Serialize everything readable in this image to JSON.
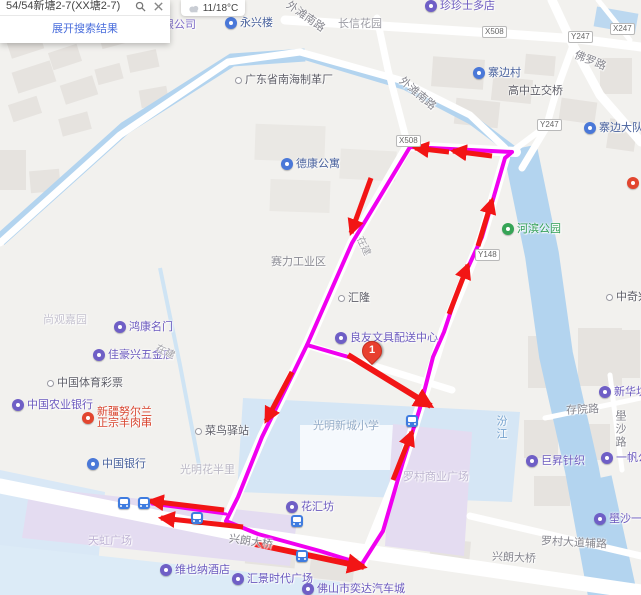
{
  "ui": {
    "search": {
      "query": "54/54新塘2-7(XX塘2-7)",
      "expand_label": "展开搜索结果"
    },
    "weather": {
      "temp": "11/18°C"
    }
  },
  "map": {
    "poi_markers": [
      {
        "label": "珍珍士多店",
        "x": 431,
        "y": 6,
        "type": "purple"
      },
      {
        "label": "永兴楼",
        "x": 231,
        "y": 23,
        "type": "blue"
      },
      {
        "label": "寨边村",
        "x": 479,
        "y": 73,
        "type": "blue"
      },
      {
        "label": "寨边大队",
        "x": 590,
        "y": 128,
        "type": "blue"
      },
      {
        "label": "德康公寓",
        "x": 287,
        "y": 164,
        "type": "blue"
      },
      {
        "label": "河滨公园",
        "x": 508,
        "y": 229,
        "type": "green"
      },
      {
        "label": "广东省南海制革厂",
        "x": 241,
        "y": 81,
        "type": "dot"
      },
      {
        "label": "汇隆",
        "x": 344,
        "y": 299,
        "type": "dot"
      },
      {
        "label": "良友文具配送中心",
        "x": 341,
        "y": 338,
        "type": "purple"
      },
      {
        "label": "鸿康名门",
        "x": 120,
        "y": 327,
        "type": "purple"
      },
      {
        "label": "佳豪兴五金店",
        "x": 99,
        "y": 355,
        "type": "purple"
      },
      {
        "label": "中国体育彩票",
        "x": 53,
        "y": 384,
        "type": "dot"
      },
      {
        "label": "中国农业银行",
        "x": 18,
        "y": 405,
        "type": "purple"
      },
      {
        "label": "新疆努尔兰\n正宗羊肉串",
        "x": 88,
        "y": 413,
        "type": "red"
      },
      {
        "label": "菜鸟驿站",
        "x": 201,
        "y": 432,
        "type": "dot"
      },
      {
        "label": "中国银行",
        "x": 93,
        "y": 464,
        "type": "blue"
      },
      {
        "label": "花汇坊",
        "x": 292,
        "y": 507,
        "type": "purple"
      },
      {
        "label": "维也纳酒店",
        "x": 166,
        "y": 570,
        "type": "purple"
      },
      {
        "label": "汇景时代广场",
        "x": 238,
        "y": 579,
        "type": "purple"
      },
      {
        "label": "佛山市奕达汽车城",
        "x": 308,
        "y": 589,
        "type": "purple"
      },
      {
        "label": "新华坊纺织",
        "x": 605,
        "y": 392,
        "type": "purple"
      },
      {
        "label": "巨昇针织",
        "x": 532,
        "y": 461,
        "type": "purple"
      },
      {
        "label": "一帆公寓",
        "x": 607,
        "y": 458,
        "type": "purple"
      },
      {
        "label": "壆沙一路三",
        "x": 600,
        "y": 519,
        "type": "purple"
      },
      {
        "label": "中奇兴",
        "x": 612,
        "y": 298,
        "type": "dot"
      },
      {
        "label": "",
        "x": 633,
        "y": 183,
        "type": "red"
      }
    ],
    "area_labels": [
      {
        "label": "限公司",
        "x": 163,
        "y": 16,
        "color": "#7d6bc8",
        "size": 11
      },
      {
        "label": "长信花园",
        "x": 338,
        "y": 15,
        "color": "#9b9ba3",
        "size": 11
      },
      {
        "label": "高中立交桥",
        "x": 508,
        "y": 82,
        "color": "#5d5d66",
        "size": 11
      },
      {
        "label": "赛力工业区",
        "x": 271,
        "y": 253,
        "color": "#8a8a92",
        "size": 11
      },
      {
        "label": "尚观嘉园",
        "x": 43,
        "y": 311,
        "color": "#c5c2cf",
        "size": 11
      },
      {
        "label": "光明花半里",
        "x": 180,
        "y": 461,
        "color": "#bab7c4",
        "size": 11
      },
      {
        "label": "光明新城小学",
        "x": 313,
        "y": 417,
        "color": "#93abc7",
        "size": 11
      },
      {
        "label": "罗村商业广场",
        "x": 403,
        "y": 468,
        "color": "#bcb4cf",
        "size": 11
      },
      {
        "label": "天虹广场",
        "x": 88,
        "y": 532,
        "color": "#beb2d4",
        "size": 11
      },
      {
        "label": "在建",
        "x": 355,
        "y": 238,
        "color": "#a3a3a8",
        "size": 10,
        "angle": 65
      },
      {
        "label": "在建",
        "x": 156,
        "y": 343,
        "color": "#a3a3a8",
        "size": 10,
        "angle": 25
      }
    ],
    "road_labels": [
      {
        "label": "外滩南路",
        "x": 284,
        "y": 8,
        "angle": 35
      },
      {
        "label": "外滩南路",
        "x": 396,
        "y": 85,
        "angle": 40
      },
      {
        "label": "佛罗路",
        "x": 574,
        "y": 52,
        "angle": 22
      },
      {
        "label": "兴朗大桥",
        "x": 229,
        "y": 533,
        "angle": 8
      },
      {
        "label": "兴朗大桥",
        "x": 492,
        "y": 549,
        "angle": 3
      },
      {
        "label": "罗村大道辅路",
        "x": 541,
        "y": 534,
        "angle": 3
      },
      {
        "label": "存院路",
        "x": 566,
        "y": 401,
        "angle": -3
      },
      {
        "label": "壆沙路",
        "x": 612,
        "y": 410,
        "vertical": true
      }
    ],
    "water_labels": [
      {
        "label": "汾江",
        "x": 493,
        "y": 415,
        "vertical": true
      }
    ],
    "road_badges": [
      {
        "label": "X508",
        "x": 482,
        "y": 26
      },
      {
        "label": "Y247",
        "x": 568,
        "y": 31
      },
      {
        "label": "X247",
        "x": 610,
        "y": 23
      },
      {
        "label": "Y247",
        "x": 537,
        "y": 119
      },
      {
        "label": "X508",
        "x": 396,
        "y": 135
      },
      {
        "label": "Y148",
        "x": 475,
        "y": 249
      }
    ],
    "bus_stops": [
      {
        "x": 124,
        "y": 503
      },
      {
        "x": 144,
        "y": 503
      },
      {
        "x": 197,
        "y": 518
      },
      {
        "x": 297,
        "y": 521
      },
      {
        "x": 302,
        "y": 556
      },
      {
        "x": 412,
        "y": 421
      }
    ],
    "origin_marker": {
      "label": "1",
      "x": 371,
      "y": 355
    },
    "route": {
      "color": "#f000f0",
      "arrow_color": "#f21515",
      "lines": [
        {
          "points": "512,152 410,147 352,243 307,345 262,437 238,497 226,521 258,534 320,551 362,564 383,531 403,462 420,408 433,357 444,332 459,287 482,237 494,196 505,158 512,152",
          "width": 4
        },
        {
          "points": "307,345 352,358",
          "width": 4
        },
        {
          "points": "226,514 152,504",
          "width": 3
        }
      ],
      "arrows": [
        {
          "x1": 492,
          "y1": 156,
          "x2": 453,
          "y2": 151,
          "w": 5
        },
        {
          "x1": 449,
          "y1": 152,
          "x2": 415,
          "y2": 148,
          "w": 5
        },
        {
          "x1": 371,
          "y1": 178,
          "x2": 351,
          "y2": 233,
          "w": 5
        },
        {
          "x1": 292,
          "y1": 372,
          "x2": 266,
          "y2": 421,
          "w": 5
        },
        {
          "x1": 224,
          "y1": 510,
          "x2": 150,
          "y2": 501,
          "w": 5
        },
        {
          "x1": 243,
          "y1": 527,
          "x2": 161,
          "y2": 518,
          "w": 5
        },
        {
          "x1": 255,
          "y1": 544,
          "x2": 364,
          "y2": 567,
          "w": 6
        },
        {
          "x1": 393,
          "y1": 480,
          "x2": 412,
          "y2": 432,
          "w": 5
        },
        {
          "x1": 449,
          "y1": 314,
          "x2": 468,
          "y2": 265,
          "w": 5
        },
        {
          "x1": 478,
          "y1": 246,
          "x2": 492,
          "y2": 200,
          "w": 5
        },
        {
          "x1": 348,
          "y1": 355,
          "x2": 431,
          "y2": 406,
          "w": 6
        }
      ]
    }
  }
}
